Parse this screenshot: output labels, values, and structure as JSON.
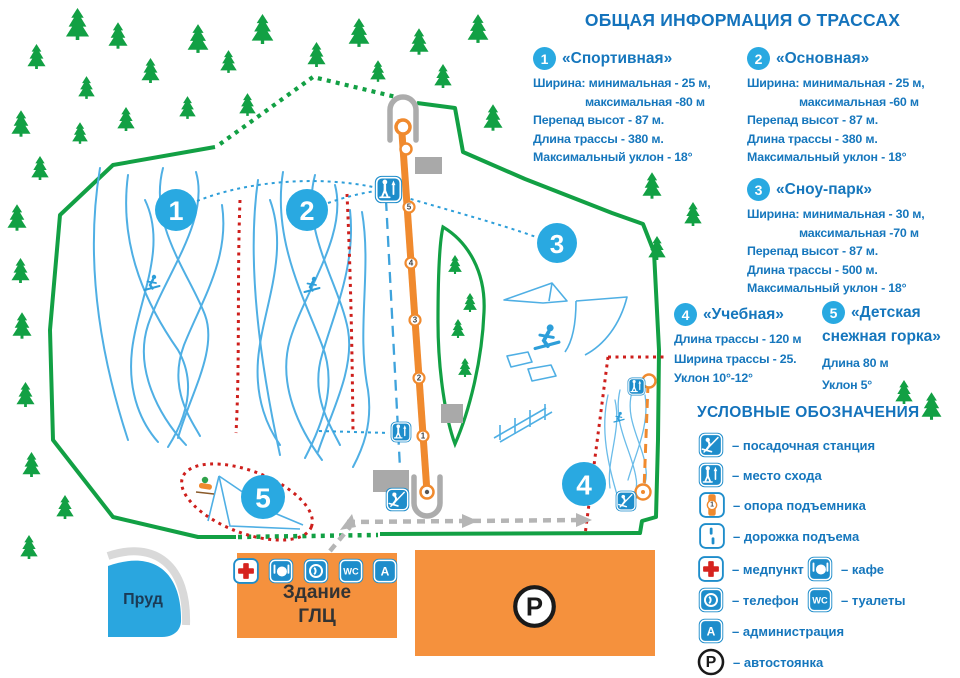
{
  "title": "ОБЩАЯ ИНФОРМАЦИЯ О ТРАССАХ",
  "sections": [
    {
      "num": "1",
      "name": "«Спортивная»",
      "lines": [
        "Ширина: минимальная - 25 м,",
        "максимальная -80 м",
        "Перепад высот - 87 м.",
        "Длина трассы - 380 м.",
        "Максимальный уклон - 18°"
      ]
    },
    {
      "num": "2",
      "name": "«Основная»",
      "lines": [
        "Ширина: минимальная - 25 м,",
        "максимальная -60 м",
        "Перепад высот - 87 м.",
        "Длина трассы - 380 м.",
        "Максимальный уклон - 18°"
      ]
    },
    {
      "num": "3",
      "name": "«Сноу-парк»",
      "lines": [
        "Ширина: минимальная - 30 м,",
        "максимальная -70 м",
        "Перепад высот - 87 м.",
        "Длина трассы - 500 м.",
        "Максимальный уклон - 18°"
      ]
    },
    {
      "num": "4",
      "name": "«Учебная»",
      "lines": [
        "Длина трассы - 120 м",
        "Ширина трассы - 25.",
        "Уклон 10°-12°"
      ]
    },
    {
      "num": "5",
      "name": "«Детская",
      "name2": "снежная горка»",
      "lines": [
        "Длина 80 м",
        "Уклон 5°"
      ]
    }
  ],
  "legend": {
    "title": "УСЛОВНЫЕ ОБОЗНАЧЕНИЯ",
    "items": [
      {
        "icon": "lift-boarding-icon",
        "label": "– посадочная станция"
      },
      {
        "icon": "lift-exit-icon",
        "label": "– место схода"
      },
      {
        "icon": "lift-tower-icon",
        "label": "– опора подъемника"
      },
      {
        "icon": "lift-walk-path-icon",
        "label": "– дорожка подъема"
      },
      {
        "icon": "medpoint-icon",
        "label": "– медпункт"
      },
      {
        "icon": "cafe-icon",
        "label": "– кафе"
      },
      {
        "icon": "phone-icon",
        "label": "– телефон"
      },
      {
        "icon": "wc-icon",
        "label": "– туалеты"
      },
      {
        "icon": "administration-icon",
        "label": "– администрация"
      },
      {
        "icon": "parking-icon",
        "label": "– автостоянка"
      }
    ]
  },
  "map": {
    "pond_label": "Пруд",
    "building_label": [
      "Здание",
      "ГЛЦ"
    ],
    "parking_symbol": "P",
    "badges": [
      "1",
      "2",
      "3",
      "4",
      "5"
    ],
    "lift_support_numbers": [
      "5",
      "4",
      "3",
      "2",
      "1"
    ],
    "tower_icon_number": "1",
    "wc_icon_text": "WC",
    "admin_icon_text": "A"
  },
  "colors": {
    "text_blue": "#1677BD",
    "badge_blue": "#29A9E1",
    "icon_blue": "#1E8DCB",
    "trail_blue": "#4FAFE4",
    "green": "#12A044",
    "lift_orange": "#F08A2E",
    "area_orange": "#F5913D",
    "red": "#CE1F1C"
  }
}
